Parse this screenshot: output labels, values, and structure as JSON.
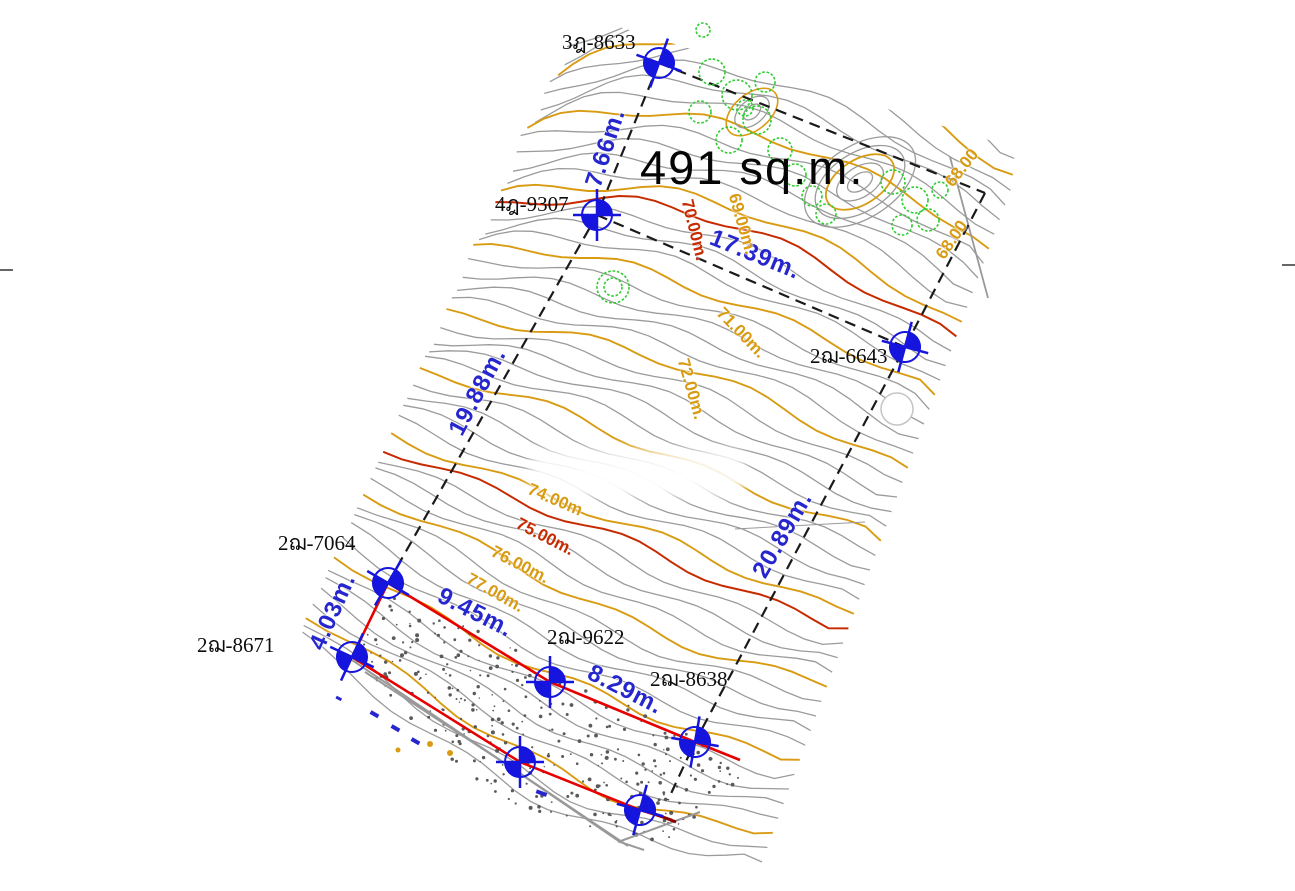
{
  "map": {
    "area_label": "491 sq.m.",
    "survey_points": [
      {
        "label": "3ฎ-8633"
      },
      {
        "label": "4ฎ-9307"
      },
      {
        "label": "2ฌ-6643"
      },
      {
        "label": "2ฌ-7064"
      },
      {
        "label": "2ฌ-8671"
      },
      {
        "label": "2ฌ-9622"
      },
      {
        "label": "2ฌ-8638"
      }
    ],
    "dimension_labels": [
      {
        "label": "7.66m."
      },
      {
        "label": "17.39m."
      },
      {
        "label": "19.88m."
      },
      {
        "label": "20.89m."
      },
      {
        "label": "9.45m."
      },
      {
        "label": "8.29m."
      },
      {
        "label": "4.03m."
      }
    ],
    "contour_labels": [
      {
        "label": "68.00",
        "color": "orange"
      },
      {
        "label": "68.00",
        "color": "orange"
      },
      {
        "label": "69.00m.",
        "color": "orange"
      },
      {
        "label": "70.00m.",
        "color": "red"
      },
      {
        "label": "71.00m.",
        "color": "orange"
      },
      {
        "label": "72.00m.",
        "color": "orange"
      },
      {
        "label": "74.00m",
        "color": "orange"
      },
      {
        "label": "75.00m.",
        "color": "red"
      },
      {
        "label": "76.00m.",
        "color": "orange"
      },
      {
        "label": "77.00m.",
        "color": "orange"
      }
    ],
    "colors": {
      "contour_minor": "#9b9b9b",
      "contour_index": "#d89b12",
      "contour_red": "#c62b00",
      "boundary_red": "#e60000",
      "boundary_black": "#1a1a1a",
      "marker_blue": "#1515dd",
      "dimension_blue": "#2626cf",
      "tree_green": "#2ecc2e",
      "stipple_gray": "#5a5a5a"
    }
  }
}
